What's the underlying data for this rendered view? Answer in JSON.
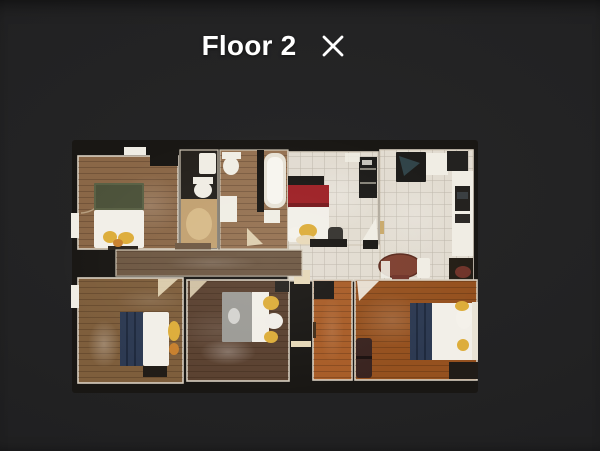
{
  "header": {
    "title": "Floor 2",
    "close_label": "Close"
  },
  "floorplan": {
    "alt": "Top-down photographic floor plan of Floor 2 of a home",
    "rooms": [
      {
        "name": "bedroom-top-left",
        "floor": "wood",
        "contents": [
          "double bed with olive-green blanket",
          "yellow pillows at foot",
          "closet door"
        ]
      },
      {
        "name": "water-closet",
        "floor": "dark with plywood patch",
        "contents": [
          "toilet",
          "small sink"
        ]
      },
      {
        "name": "bathroom",
        "floor": "wood",
        "contents": [
          "toilet",
          "vanity sink",
          "bathtub"
        ]
      },
      {
        "name": "bedroom-red",
        "floor": "white tile",
        "contents": [
          "double bed with red blanket",
          "dark chair",
          "ladder shelf",
          "white board"
        ]
      },
      {
        "name": "kitchen",
        "floor": "white tile",
        "contents": [
          "black stove",
          "white counters",
          "dark wall oven",
          "upper cabinet"
        ]
      },
      {
        "name": "dining-nook",
        "floor": "white tile",
        "contents": [
          "round brown table",
          "white high chair",
          "dark red chair"
        ]
      },
      {
        "name": "hallway-center",
        "floor": "wood",
        "contents": []
      },
      {
        "name": "bedroom-bottom-left",
        "floor": "wood",
        "contents": [
          "bed with navy blanket",
          "yellow chair",
          "dark bench",
          "closet door"
        ]
      },
      {
        "name": "bedroom-bottom-middle",
        "floor": "dark wood",
        "contents": [
          "bed with gray blanket",
          "yellow and white pillows"
        ]
      },
      {
        "name": "hallway-right",
        "floor": "orange wood",
        "contents": [
          "dark cabinet"
        ]
      },
      {
        "name": "bedroom-bottom-right",
        "floor": "orange wood",
        "contents": [
          "bed with navy throw",
          "white pillows",
          "dark dresser",
          "dark luggage"
        ]
      }
    ],
    "palette": {
      "background": "#212123",
      "plan_void": "#191714",
      "wall": "#d8cfc0",
      "wood_light": "#8a6747",
      "wood_mid": "#957252",
      "wood_gray": "#6e5843",
      "wood_warm": "#7e5e3c",
      "wood_dark": "#5a4130",
      "wood_orange": "#a85d28",
      "wood_orange_deep": "#95511f",
      "plywood": "#c2a171",
      "plywood_light": "#dcc08f",
      "tile": "#e2dcd1",
      "white_fixture": "#f0ede4",
      "bed_white": "#f2efe8",
      "bed_green": "#5a6145",
      "bed_red": "#9e2126",
      "bed_navy": "#2d3a52",
      "bed_gray": "#9c9b96",
      "pillow_yellow": "#ddad3a",
      "pillow_orange": "#c8802e",
      "dark_appliance": "#1d1c1a",
      "dark_furniture": "#211c17",
      "table_brown": "#7e4030",
      "chair_maroon": "#70342a",
      "door_beige": "#e6d8b8",
      "title_text": "#ffffff"
    }
  }
}
